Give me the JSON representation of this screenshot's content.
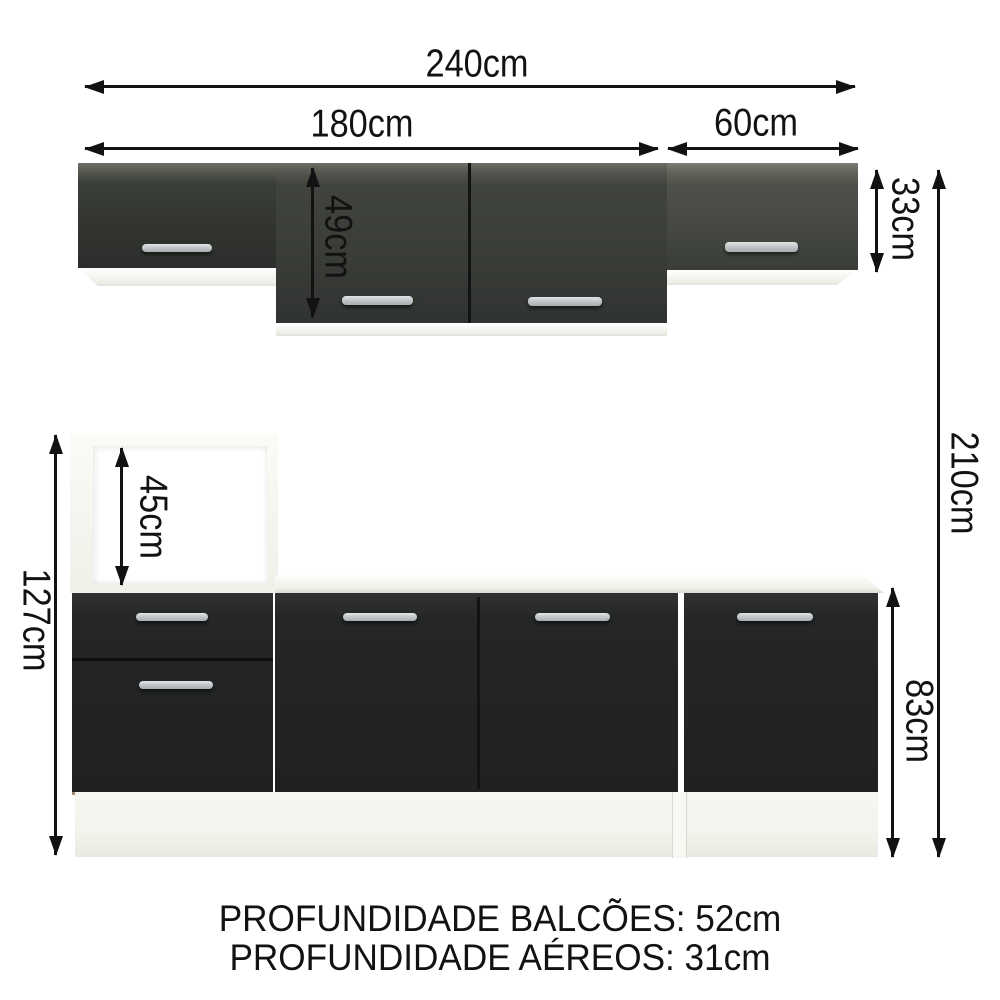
{
  "dimensions": {
    "total_width": "240cm",
    "run_width": "180cm",
    "right_cabinet_width": "60cm",
    "tall_wall_cabinet_height": "49cm",
    "wall_cabinet_height": "33cm",
    "total_height": "210cm",
    "niche_height": "45cm",
    "tall_base_unit_height": "127cm",
    "base_unit_height": "83cm"
  },
  "footer": {
    "line1": "PROFUNDIDADE BALCÕES: 52cm",
    "line2": "PROFUNDIDADE AÉREOS: 31cm"
  },
  "colors": {
    "arrow": "#121212",
    "text": "#121212",
    "front-dark": "#242627",
    "upper-left-mid": "#33362f",
    "upper-mid-mid": "#3a3d38",
    "upper-right-mid": "#474a43",
    "white-body": "#f4f4ee",
    "white-bright": "#ffffff",
    "handle-light": "#e2e5e6",
    "handle-mid": "#a7acaf",
    "edge-tan": "#9a8a6f"
  }
}
